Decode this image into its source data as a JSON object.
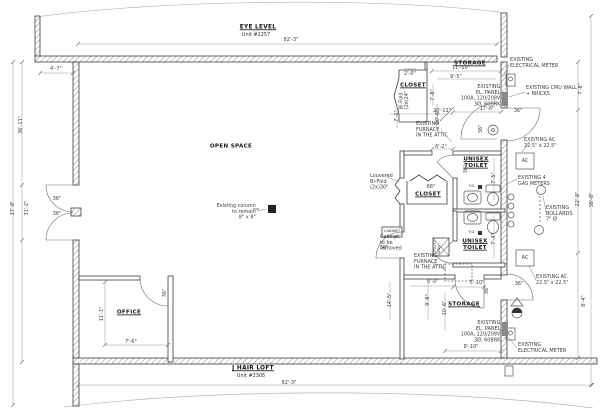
{
  "headers": {
    "top_name": "EYE LEVEL",
    "top_unit": "Unit #2257",
    "bottom_name": "J HAIR LOFT",
    "bottom_unit": "Unit #2305"
  },
  "rooms": {
    "open_space": "OPEN SPACE",
    "office": "OFFICE",
    "closet_1": "CLOSET",
    "closet_2": "CLOSET",
    "storage_top": "STORAGE",
    "storage_bottom": "STORAGE",
    "toilet_top": "UNISEX\nTOILET",
    "toilet_bottom": "UNISEX\nTOILET"
  },
  "dims": {
    "overall_top": "82'-3\"",
    "overall_bottom": "82'-3\"",
    "left_offset": "4'-7\"",
    "left_upper": "36'-11\"",
    "left_full": "37'-8\"",
    "left_inner": "31'-2\"",
    "right_upper": "7'-8\"",
    "right_mid": "22'-8\"",
    "right_lower": "8'-4\"",
    "right_full": "38'-8\"",
    "storage_top_w1": "11'-10\"",
    "storage_top_w2": "9'-5\"",
    "closet1_offset": "2'-0\"",
    "closet1_depth": "7'-8\"",
    "closet1_w": "7'-1\"",
    "hall_upper": "10'-6\"",
    "open_east": "20'-11\"",
    "storage_door": "17'-6\"",
    "vest_w": "6'-2\"",
    "toilet_top_d": "7'-5\"",
    "closet2_opening": "66\"",
    "toilet_bottom_d": "7'-4\"",
    "vest2_w": "6'-0\"",
    "vest2_h": "14'-5\"",
    "hall_lower": "9'-8\"",
    "storage2_door": "5'-10\"",
    "storage2_d": "10'-6\"",
    "panel_w": "8'-10\"",
    "office_d": "11'-1\"",
    "office_w": "7'-6\"",
    "door_std": "36\""
  },
  "notes": {
    "meter1": "EXISTING\nELECTRICAL METER",
    "meter2": "EXISTING\nELECTRICAL METER",
    "cmu": "EXISTING CMU WALL\n+ BRICKS",
    "panel1": "EXISTING\nEL. PANEL\n100A, 120/208V\n3Ø, 60BRK",
    "panel2": "EXISTING\nEL. PANEL\n100A, 120/208V\n3Ø, 60BRK",
    "furnace1": "EXISTING\nFURNACE\nIN THE ATTIC",
    "furnace2": "EXISTING\nFURNACE\nIN THE ATTIC",
    "ac1": "EXISTING AC\n22.5\" x 22.5\"",
    "ac2": "EXISTING AC\n22.5\" x 22.5\"",
    "gas": "EXISTING 4\nGAS METERS",
    "bollards": "EXISTING\nBOLLARDS\n7\" Ø",
    "column": "Existing column\nto remain\n8\" x 8\"",
    "louvered": "Louvered\nBi-Fold\n(2x)30\"",
    "bifold24": "Bi-Fold\n(2x)24\"",
    "cabinet_removed": "Cabinet\nto be\nremoved"
  },
  "fixtures": {
    "ac": "AC",
    "fd": "F.D.",
    "cabinet": "CABINET",
    "utility_sink": "UTILITY\nSINK"
  }
}
